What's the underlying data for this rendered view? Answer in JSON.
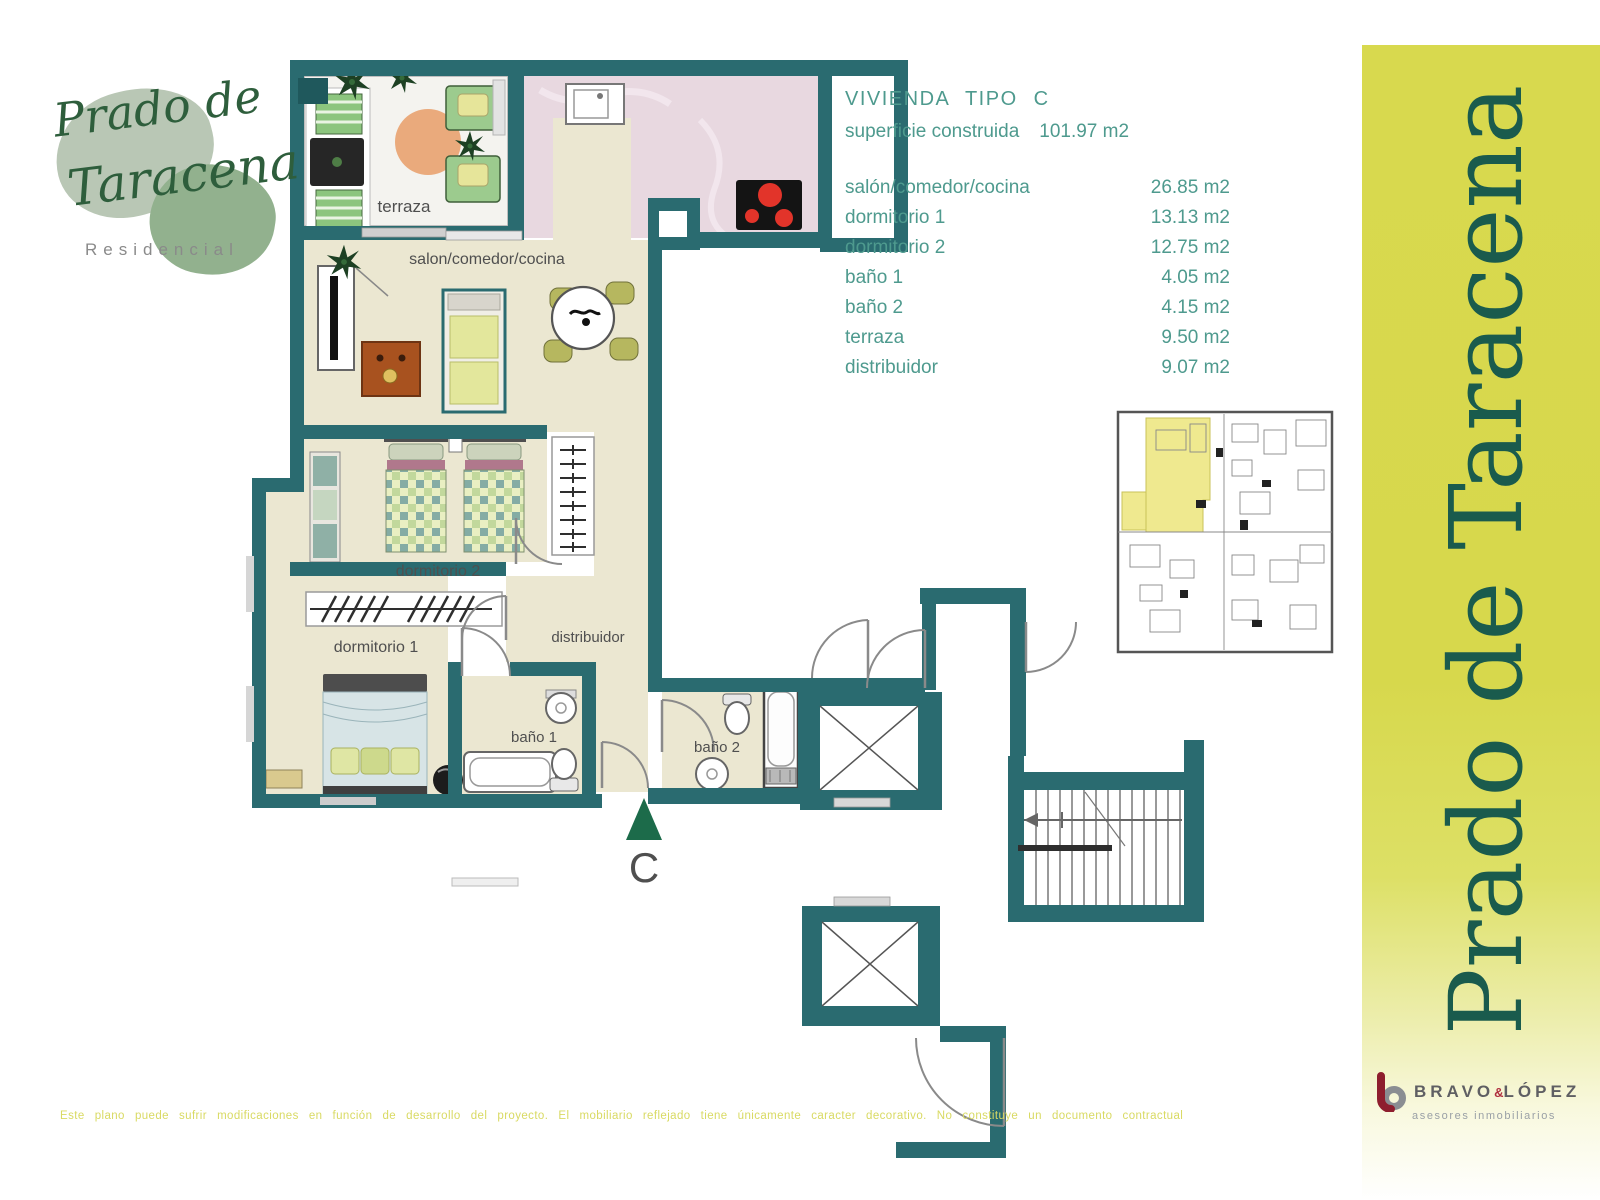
{
  "logo": {
    "title_line1": "Prado de",
    "title_line2": "Taracena",
    "subtitle": "Residencial"
  },
  "unit_info": {
    "title": "VIVIENDA TIPO C",
    "surface_label": "superficie construida",
    "surface_value": "101.97 m2",
    "rows": [
      {
        "label": "salón/comedor/cocina",
        "value": "26.85 m2"
      },
      {
        "label": "dormitorio 1",
        "value": "13.13 m2"
      },
      {
        "label": "dormitorio 2",
        "value": "12.75 m2"
      },
      {
        "label": "baño 1",
        "value": "4.05 m2"
      },
      {
        "label": "baño 2",
        "value": "4.15 m2"
      },
      {
        "label": "terraza",
        "value": "9.50 m2"
      },
      {
        "label": "distribuidor",
        "value": "9.07 m2"
      }
    ]
  },
  "floorplan": {
    "rooms": {
      "terraza": "terraza",
      "salon": "salon/comedor/cocina",
      "dormitorio2": "dormitorio 2",
      "dormitorio1": "dormitorio 1",
      "distribuidor": "distribuidor",
      "bano1": "baño 1",
      "bano2": "baño 2"
    },
    "entrance_label": "C"
  },
  "side_banner": {
    "text": "Prado de Taracena"
  },
  "agency": {
    "name1": "BRAVO",
    "ampersand": "&",
    "name2": "LÓPEZ",
    "tagline": "asesores inmobiliarios"
  },
  "disclaimer": "Este plano puede sufrir modificaciones en función de desarrollo del proyecto. El mobiliario reflejado tiene únicamente caracter decorativo. No constituye un documento contractual",
  "colors": {
    "wall_teal": "#2a6b70",
    "floor_cream": "#ebe7d1",
    "banner_yellow": "#d8d94e",
    "banner_text_green": "#1a5b4d",
    "info_green": "#4e9a8e",
    "mini_plan_highlight": "#efe98f",
    "logo_green": "#2e5e3c",
    "agency_red": "#8e1e2e"
  }
}
